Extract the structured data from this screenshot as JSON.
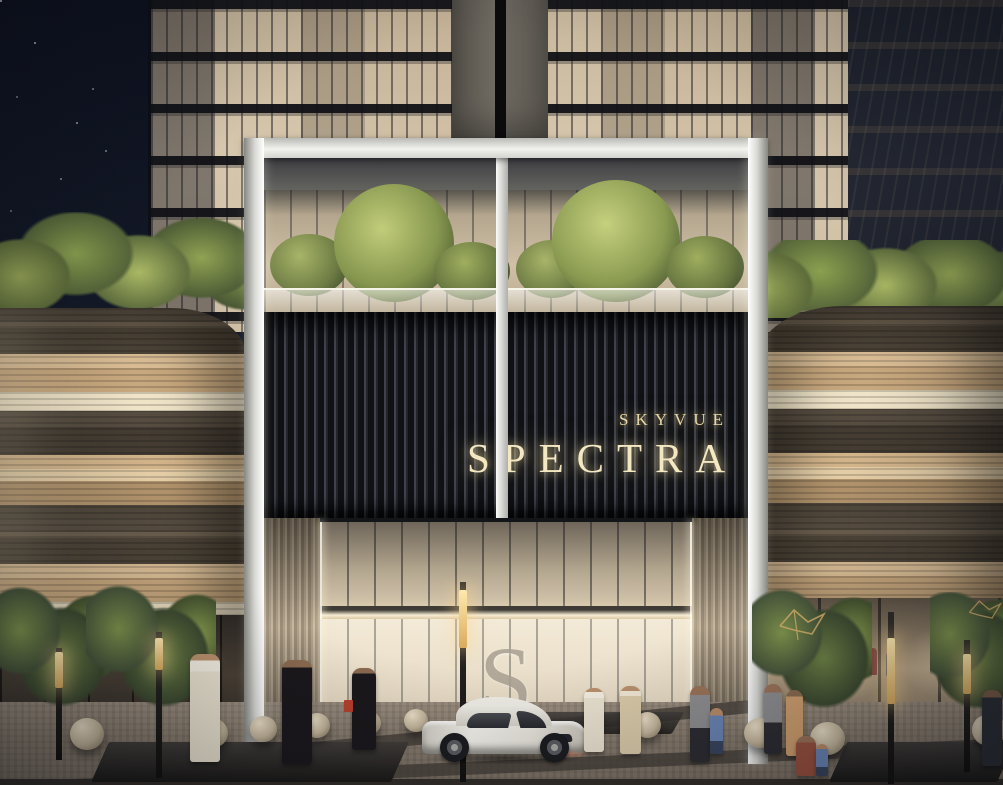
{
  "scene": {
    "sign": {
      "line1": "SKYVUE",
      "line2": "SPECTRA"
    },
    "lobby_monogram": "S"
  },
  "colors": {
    "sky": "#141927",
    "sign_panel": "#1b1d22",
    "sign_text_glow": "#f4e8c2",
    "portal_frame": "#d9d9d5",
    "podium_dark": "#564c40",
    "podium_tan": "#d4b68e",
    "podium_cream": "#f0e4c8",
    "tower_glass_warm": "#cdbca2",
    "foliage_green": "#8ba04f",
    "pavement": "#877b6d",
    "car_body": "#f1efe9",
    "bird_decor_gold": "#d4b06a"
  }
}
